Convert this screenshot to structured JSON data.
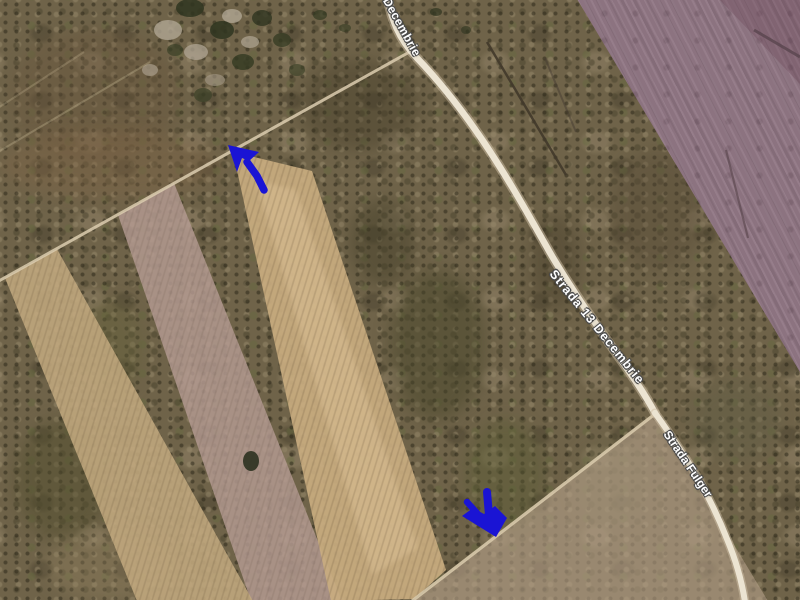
{
  "app": {
    "name": "satellite-map-view",
    "view": "satellite imagery"
  },
  "map": {
    "street_labels": [
      {
        "id": "top",
        "text": "Decembrie"
      },
      {
        "id": "middle",
        "text": "Strada 13 Decembrie"
      },
      {
        "id": "right",
        "text": "Strada Fulger"
      }
    ],
    "annotations": {
      "arrow_color": "#1a14d4",
      "arrows": [
        {
          "id": "upper",
          "direction": "up-left",
          "location": "top end of highlighted parcel"
        },
        {
          "id": "lower",
          "direction": "down-right",
          "location": "bottom end of highlighted parcel at dirt track"
        }
      ]
    },
    "colors": {
      "scrub_base": "#6f6349",
      "purple_field": "#8c7380",
      "parcel_strip": "#c9ac80",
      "pink_strip": "#b49b93",
      "tan_strip": "#c2a87e",
      "road": "#ece4d2",
      "label_text": "#ffffff"
    }
  }
}
